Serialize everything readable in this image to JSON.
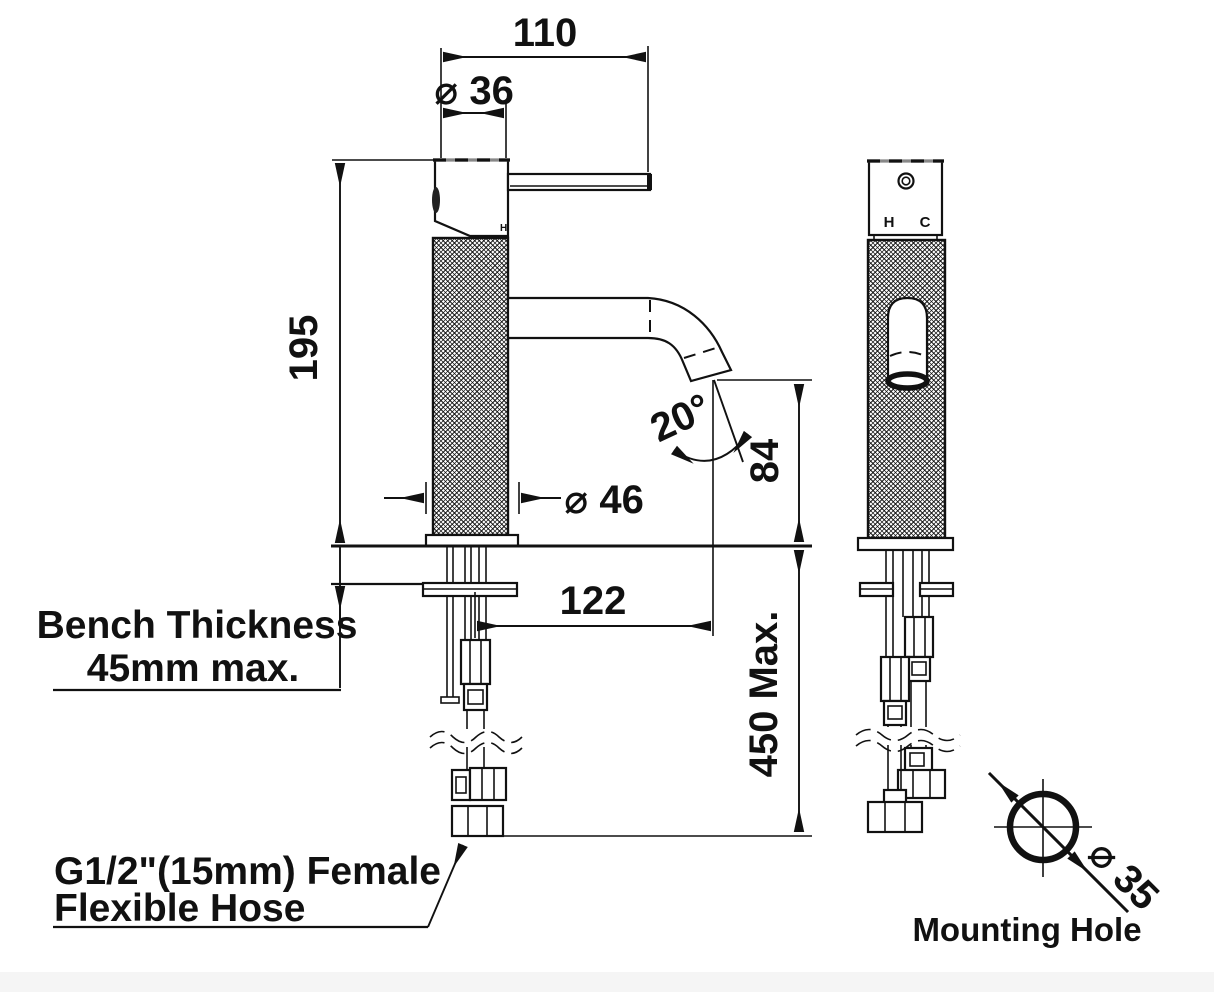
{
  "drawing": {
    "type": "technical-dimension-drawing",
    "subject": "basin mixer tap - front and side elevations with mounting hole detail",
    "colors": {
      "line": "#111111",
      "background": "#ffffff",
      "footer_strip": "#f5f5f5"
    },
    "dimensions": {
      "handle_reach": "110",
      "top_diameter": "⌀ 36",
      "height_to_bench": "195",
      "body_diameter": "⌀ 46",
      "outlet_angle": "20°",
      "outlet_height": "84",
      "spout_reach": "122",
      "hose_drop": "450 Max.",
      "mounting_hole_diameter": "⌀ 35"
    },
    "notes": {
      "bench_line1": "Bench Thickness",
      "bench_line2": "45mm max.",
      "hose_line1": "G1/2\"(15mm) Female",
      "hose_line2": "Flexible Hose",
      "mounting_hole_caption": "Mounting Hole"
    },
    "markers": {
      "hot": "H",
      "cold": "C",
      "handle_hot": "H"
    }
  }
}
